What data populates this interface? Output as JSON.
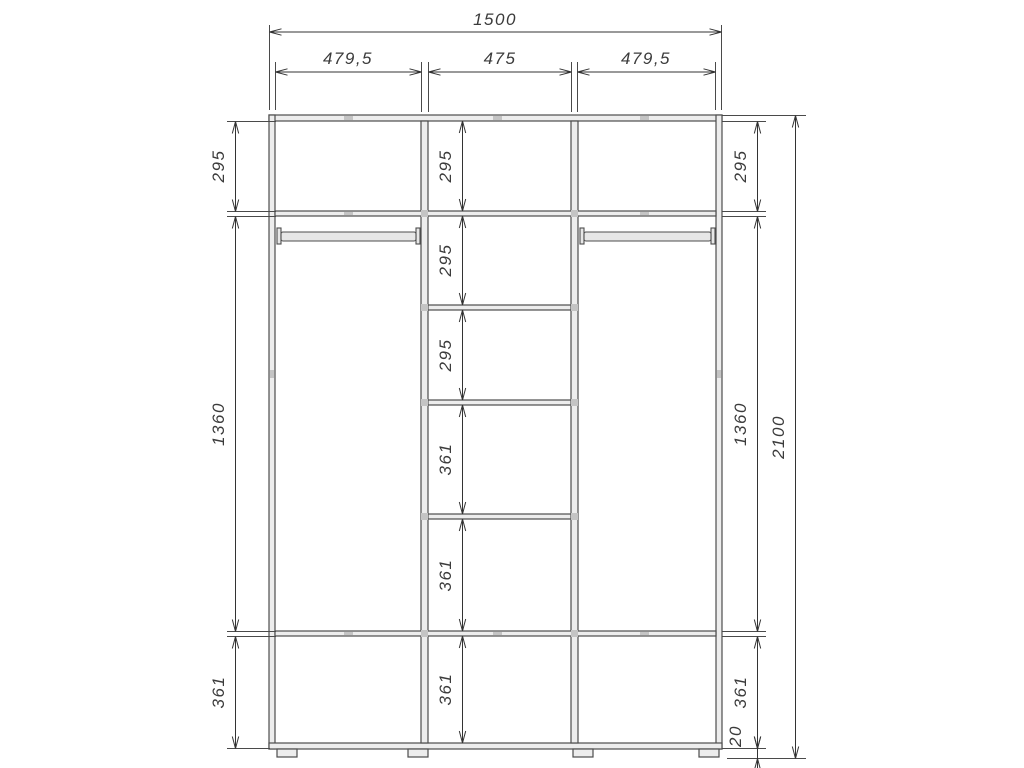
{
  "drawing": {
    "type": "wardrobe-cabinet-dimension-drawing",
    "line_color": "#4d4d4d",
    "dim_color": "#333333",
    "background": "#ffffff"
  },
  "dims": {
    "total_width": "1500",
    "total_height": "2100",
    "top_sections": [
      "479,5",
      "475",
      "479,5"
    ],
    "left_column": [
      "295",
      "1360",
      "361"
    ],
    "middle_column": [
      "295",
      "295",
      "295",
      "361",
      "361",
      "361"
    ],
    "right_column": [
      "295",
      "1360",
      "361",
      "20"
    ]
  }
}
